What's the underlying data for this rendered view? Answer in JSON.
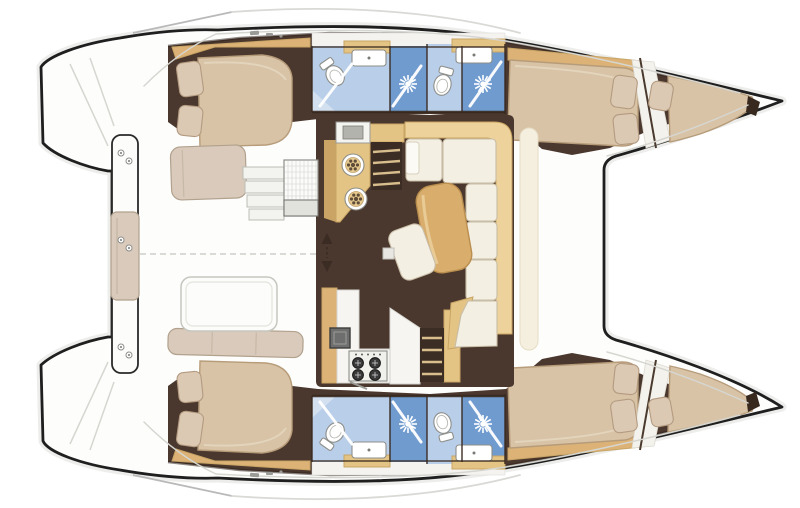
{
  "meta": {
    "title": "Catamaran yacht interior floor plan, top view",
    "orientation": {
      "bow": "right",
      "stern": "left",
      "port_hull": "top",
      "starboard_hull": "bottom"
    }
  },
  "colors": {
    "background": "#ffffff",
    "hull_outline": "#1f1f1f",
    "deck": "#fdfdfc",
    "deck_seam": "#d6d6d1",
    "floor_dark": "#4a372d",
    "wall_dark": "#38291f",
    "wood": "#e4c484",
    "wood_dark": "#c9a465",
    "wood_mid": "#dcb277",
    "table_wood": "#d9ad6c",
    "mattress": "#d8c3a6",
    "pillow": "#dcc9b3",
    "cushion_cream": "#f4efe3",
    "sofa_backrest": "#eed29b",
    "bench_beige": "#d9cabb",
    "bath_blue_light": "#b9cfe9",
    "bath_blue_mid": "#6f9bcf",
    "bath_blue_soft": "#d3e0f0",
    "appliance_gray": "#6e6e6e",
    "stair_well_dark": "#3c2d24",
    "stair_tread_light": "#d8bd8d",
    "pale_band": "#f5efe0"
  },
  "legend": {
    "port_hull": {
      "aft_cabin": {
        "name": "aft double cabin",
        "pillow_count": 2
      },
      "aft_head": {
        "name": "aft bathroom",
        "fixtures": [
          "toilet-icon",
          "sink-icon",
          "shower-screen"
        ]
      },
      "shower_stall": {
        "name": "separate shower stall",
        "fixtures": [
          "shower-head-icon"
        ]
      },
      "fwd_head": {
        "name": "forward bathroom",
        "fixtures": [
          "toilet-icon",
          "sink-icon",
          "shower-head-icon"
        ]
      },
      "fwd_cabin": {
        "name": "forward cabin with double berth and bow berth",
        "pillow_count": 3
      }
    },
    "starboard_hull": {
      "name": "starboard hull",
      "note": "mirror image of port hull layout"
    },
    "salon": {
      "galley_port_corner": {
        "round_basin_count": 2,
        "appliances": [
          "oven-appliance-icon"
        ]
      },
      "galley_starboard_corner": {
        "burner_count": 4,
        "appliances": [
          "sink-appliance-icon",
          "stove-icon"
        ]
      },
      "dinette": {
        "name": "U-shaped settee with dining table",
        "seat_cushion_count": 6
      },
      "companionway_count": 2,
      "sliding_door": {
        "icon": "double-arrow-icon"
      }
    },
    "cockpit": {
      "aft_bench": {
        "name": "transom crossbeam bench with center cushion"
      },
      "port_bench": {
        "name": "port cockpit seat"
      },
      "starboard_bench": {
        "name": "starboard cockpit sofa"
      },
      "table": {
        "name": "cockpit table"
      },
      "helm_steps": {
        "step_count": 4
      },
      "helm_seat": {
        "name": "mesh helm seat module"
      },
      "cleat_pair_count": 3
    },
    "foredeck": {
      "trampoline": {
        "name": "trampoline area between bows"
      }
    },
    "transoms": {
      "name": "swim steps on both transoms"
    }
  }
}
